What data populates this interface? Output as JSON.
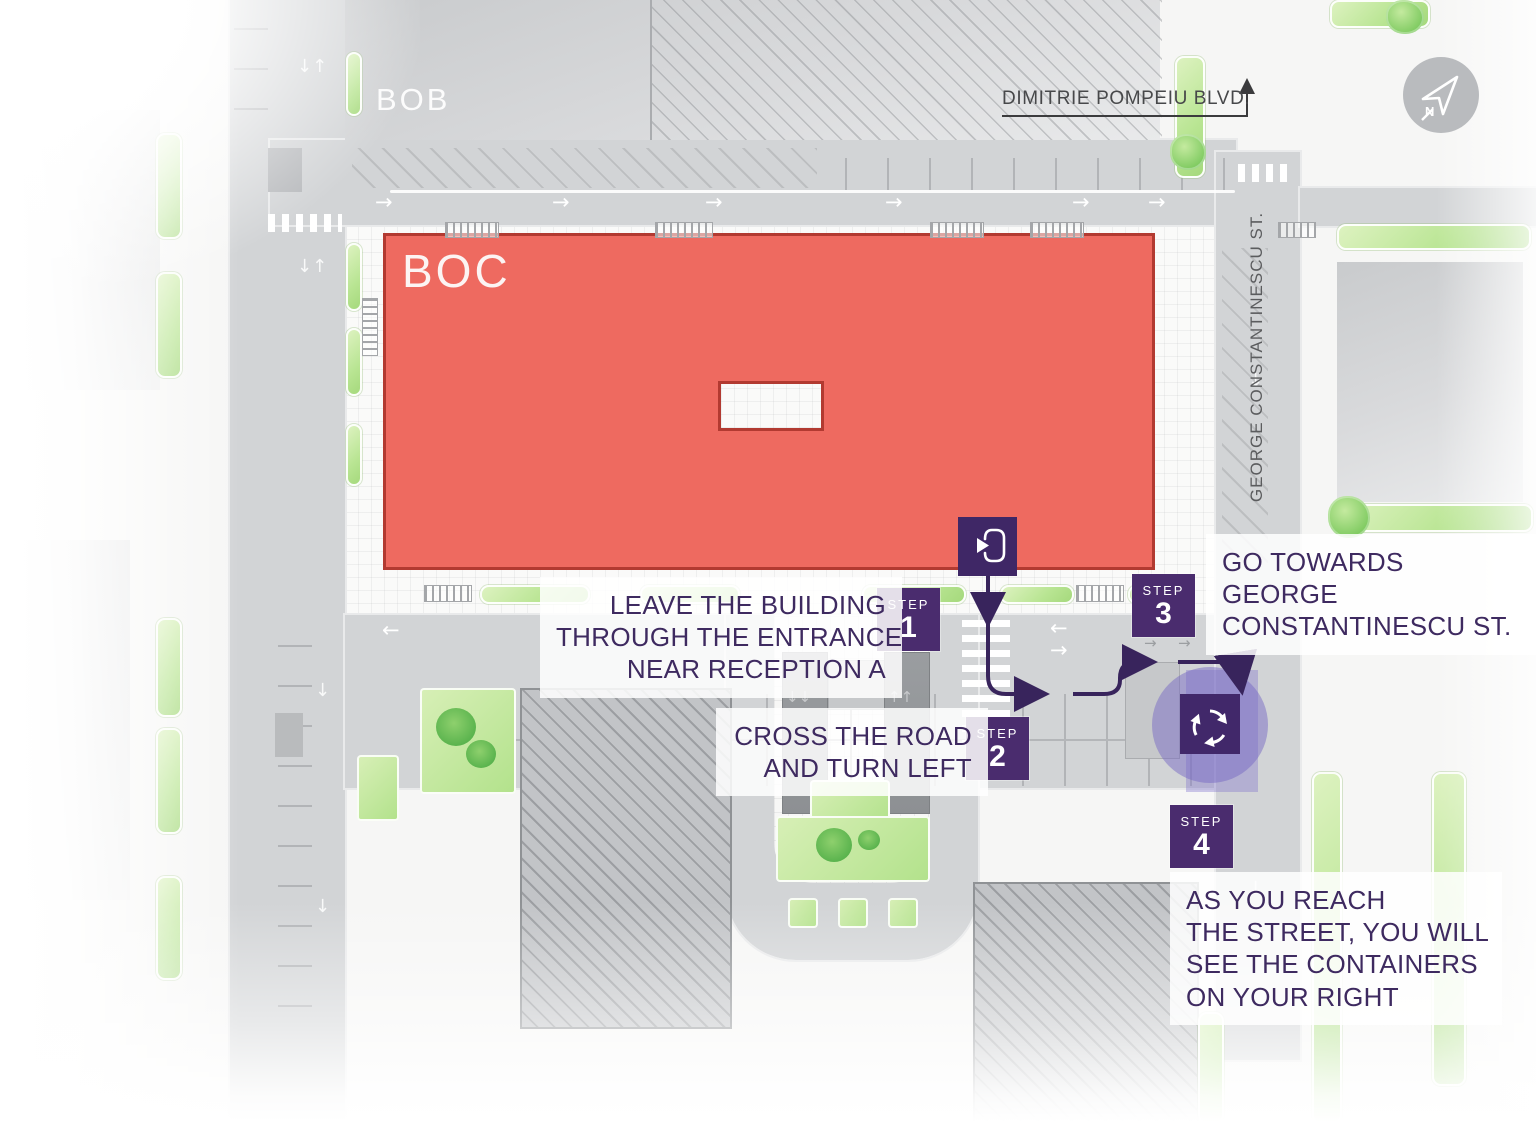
{
  "title": "BOC recycling containers wayfinding map",
  "streets": {
    "dimitrie_pompeiu": "DIMITRIE POMPEIU BLVD.",
    "george_constantinescu": "GEORGE CONSTANTINESCU ST."
  },
  "buildings": {
    "bob": "BOB",
    "boc": "BOC"
  },
  "compass": {
    "letter": "N"
  },
  "steps": [
    {
      "label": "STEP",
      "number": "1",
      "lines": [
        "LEAVE THE BUILDING",
        "THROUGH THE ENTRANCE",
        "NEAR RECEPTION A"
      ]
    },
    {
      "label": "STEP",
      "number": "2",
      "lines": [
        "CROSS THE ROAD",
        "AND TURN LEFT"
      ]
    },
    {
      "label": "STEP",
      "number": "3",
      "lines": [
        "GO TOWARDS",
        "GEORGE",
        "CONSTANTINESCU ST."
      ]
    },
    {
      "label": "STEP",
      "number": "4",
      "lines": [
        "AS YOU REACH",
        "THE STREET, YOU WILL",
        "SEE THE CONTAINERS",
        "ON YOUR RIGHT"
      ]
    }
  ],
  "icons": {
    "exit": "exit-door-icon",
    "recycle": "recycling-icon",
    "compass": "compass-north-icon"
  },
  "colors": {
    "accent_purple": "#4a2c6e",
    "route_purple": "#38245c",
    "boc_fill": "#ee6a60",
    "boc_border": "#b23a31",
    "road_gray": "#d2d4d6",
    "hedge_green": "#b9e593",
    "note_text": "#3e2a60"
  }
}
